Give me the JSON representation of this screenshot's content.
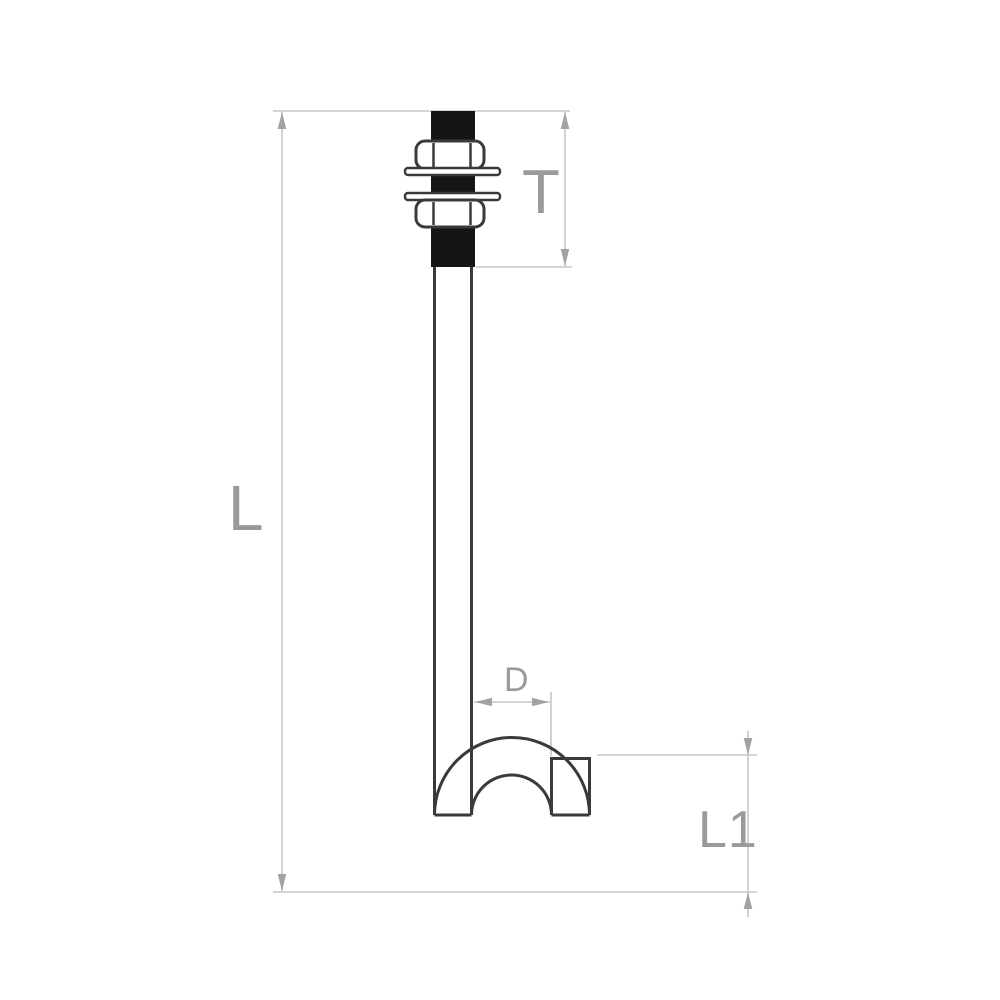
{
  "diagram": {
    "type": "technical-drawing",
    "subject": "j-bolt with hex nuts and washers",
    "colors": {
      "background": "#ffffff",
      "outline": "#3a3a3a",
      "thread_fill": "#151515",
      "dimension_line": "#c7c7c7",
      "arrowhead": "#a3a3a3",
      "label": "#9a9a9a"
    },
    "dimensions": {
      "total_length_label": "L",
      "thread_length_label": "T",
      "hook_diameter_label": "D",
      "hook_height_label": "L1"
    }
  }
}
